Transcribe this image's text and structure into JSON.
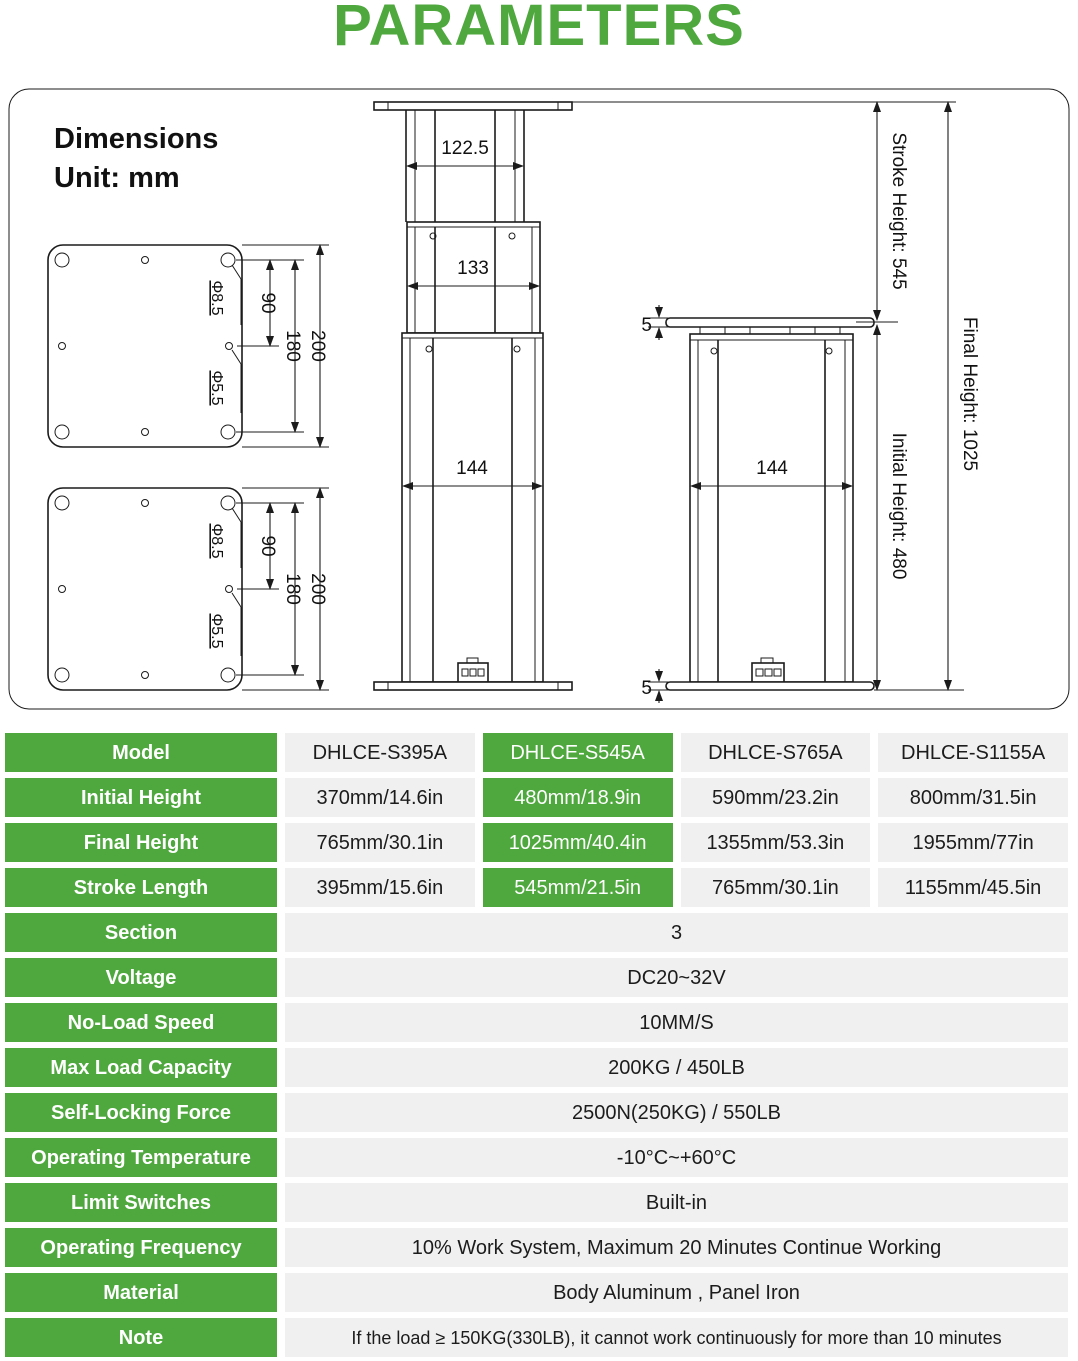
{
  "title": "PARAMETERS",
  "accent_color": "#4FA83E",
  "cell_color": "#F0F0F0",
  "diagram": {
    "heading1": "Dimensions",
    "heading2": "Unit: mm",
    "labels": {
      "phi_large": "Φ8.5",
      "phi_small": "Φ5.5",
      "dim_90": "90",
      "dim_180": "180",
      "dim_200": "200",
      "top_width": "122.5",
      "mid_width": "133",
      "bottom_width": "144",
      "collapsed_width": "144",
      "plate_thickness": "5",
      "stroke_height": "Stroke Height: 545",
      "final_height": "Final Height: 1025",
      "initial_height": "Initial Height: 480"
    }
  },
  "table": {
    "spec_rows": [
      {
        "label": "Model",
        "values": [
          "DHLCE-S395A",
          "DHLCE-S545A",
          "DHLCE-S765A",
          "DHLCE-S1155A"
        ]
      },
      {
        "label": "Initial Height",
        "values": [
          "370mm/14.6in",
          "480mm/18.9in",
          "590mm/23.2in",
          "800mm/31.5in"
        ]
      },
      {
        "label": "Final Height",
        "values": [
          "765mm/30.1in",
          "1025mm/40.4in",
          "1355mm/53.3in",
          "1955mm/77in"
        ]
      },
      {
        "label": "Stroke Length",
        "values": [
          "395mm/15.6in",
          "545mm/21.5in",
          "765mm/30.1in",
          "1155mm/45.5in"
        ]
      }
    ],
    "full_rows": [
      {
        "label": "Section",
        "value": "3"
      },
      {
        "label": "Voltage",
        "value": "DC20~32V"
      },
      {
        "label": "No-Load Speed",
        "value": "10MM/S"
      },
      {
        "label": "Max Load Capacity",
        "value": "200KG / 450LB"
      },
      {
        "label": "Self-Locking Force",
        "value": "2500N(250KG) / 550LB"
      },
      {
        "label": "Operating Temperature",
        "value": "-10°C~+60°C"
      },
      {
        "label": "Limit Switches",
        "value": "Built-in"
      },
      {
        "label": "Operating Frequency",
        "value": "10% Work System, Maximum 20 Minutes Continue Working"
      },
      {
        "label": "Material",
        "value": "Body Aluminum ,  Panel Iron"
      },
      {
        "label": "Note",
        "value": "If the load ≥ 150KG(330LB), it cannot work continuously for more than 10 minutes"
      }
    ]
  }
}
